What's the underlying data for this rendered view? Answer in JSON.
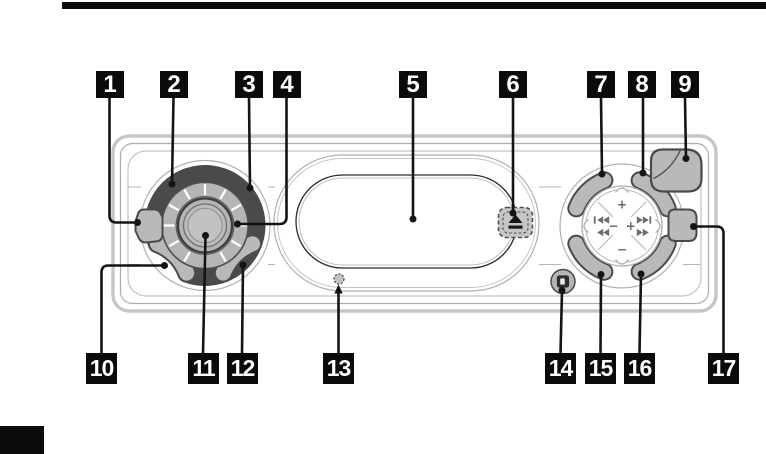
{
  "figure": {
    "kind": "car-stereo-front-panel-callout-diagram",
    "callout_count": 17
  },
  "callouts": [
    {
      "number": "1",
      "points_to": "left-side-button"
    },
    {
      "number": "2",
      "points_to": "knob-button-top-left"
    },
    {
      "number": "3",
      "points_to": "knob-button-top-right"
    },
    {
      "number": "4",
      "points_to": "rotary-notched-ring"
    },
    {
      "number": "5",
      "points_to": "display-window"
    },
    {
      "number": "6",
      "points_to": "eject-button"
    },
    {
      "number": "7",
      "points_to": "pad-button-top-left"
    },
    {
      "number": "8",
      "points_to": "pad-button-top-right"
    },
    {
      "number": "9",
      "points_to": "corner-button"
    },
    {
      "number": "10",
      "points_to": "knob-button-bottom-left"
    },
    {
      "number": "11",
      "points_to": "volume-knob"
    },
    {
      "number": "12",
      "points_to": "knob-button-bottom-right"
    },
    {
      "number": "13",
      "points_to": "reset-hole"
    },
    {
      "number": "14",
      "points_to": "release-button"
    },
    {
      "number": "15",
      "points_to": "pad-button-bottom-left"
    },
    {
      "number": "16",
      "points_to": "pad-button-bottom-right"
    },
    {
      "number": "17",
      "points_to": "right-side-button"
    }
  ],
  "dpad": {
    "plus": "+",
    "minus": "−"
  },
  "icons": [
    "eject-icon",
    "prev-track-icon",
    "rewind-icon",
    "next-track-icon",
    "fast-forward-icon",
    "release-button-icon",
    "reset-hole"
  ],
  "colors": {
    "callout_bg": "#0b0b0b",
    "callout_text": "#ffffff",
    "button_fill": "#b9b9b9",
    "button_border": "#4a4a4a",
    "chassis_outline": "#c6c6c6",
    "panel_line": "#ababab",
    "display_line": "#2b2b2b",
    "leader_line": "#141414"
  }
}
